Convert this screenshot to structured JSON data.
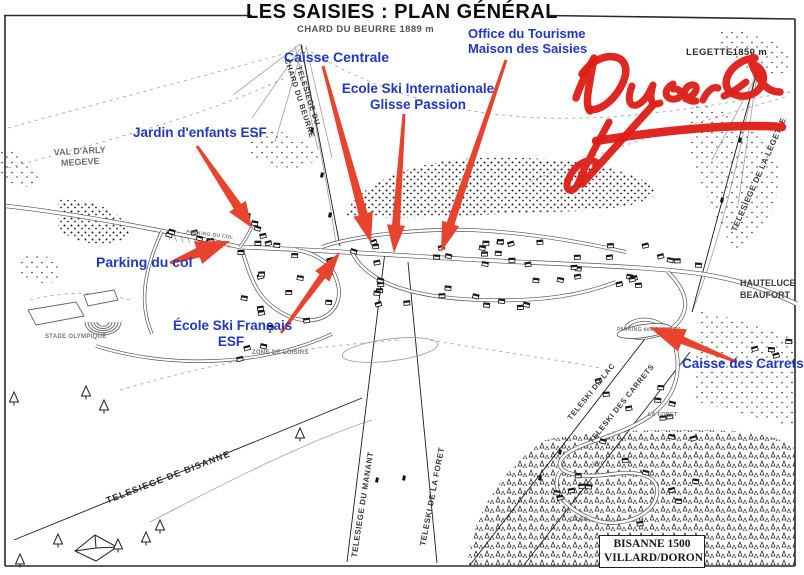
{
  "title": "LES SAISIES : PLAN GÉNÉRAL",
  "peaks": {
    "chard_du_beurre": "CHARD DU BEURRE 1889 m",
    "legette": "LEGETTE1850 m"
  },
  "annotations": {
    "office_tourisme": {
      "line1": "Office du Tourisme",
      "line2": "Maison des Saisies"
    },
    "caisse_centrale": {
      "label": "Caisse Centrale"
    },
    "ecole_ski_internationale": {
      "line1": "Ecole Ski Internationale",
      "line2": "Glisse Passion"
    },
    "jardin_enfants": {
      "label": "Jardin d'enfants ESF"
    },
    "parking_du_col": {
      "label": "Parking du col"
    },
    "ecole_ski_francais": {
      "line1": "École Ski Français",
      "line2": "ESF"
    },
    "caisse_des_carrets": {
      "label": "Caisse des Carrets"
    }
  },
  "lifts": {
    "chard": {
      "line1": "TELESIEGE DU",
      "line2": "CHARD DU BEURRE"
    },
    "legette": "TELESIEGE DE LA LEGETTE",
    "bisanne": "TELESIEGE DE BISANNE",
    "manant": "TELESIEGE DU MANANT",
    "foret": "TELESKI DE LA FORET",
    "lac": "TELESKI DU LAC",
    "carrets": "TELESKI DES CARRETS"
  },
  "places": {
    "val_arly": "VAL D'ARLY",
    "megeve": "MEGEVE",
    "stade_olympique": "STADE OLYMPIQUE",
    "zone_de_loisirs": "ZONE DE LOISIRS",
    "hauteluce": "HAUTELUCE",
    "beaufort": "BEAUFORT",
    "la_foret": "LA FORET",
    "vvf": "VVF",
    "ccas": "CCAS",
    "parking_des_carrets": "PARKING des CARRETS",
    "parking_du_col_road": "PARKING DU COL",
    "bisanne_1500": {
      "line1": "BISANNE 1500",
      "line2": "VILLARD/DORON"
    }
  },
  "handwriting": {
    "scribble_reading": "Dusero"
  },
  "colors": {
    "annotation_blue": "#2238c0",
    "arrow_red": "#e8432c",
    "scribble_red": "#dd1f18",
    "ink": "#1c1c1c",
    "sketch_gray": "#a8a8a8"
  }
}
